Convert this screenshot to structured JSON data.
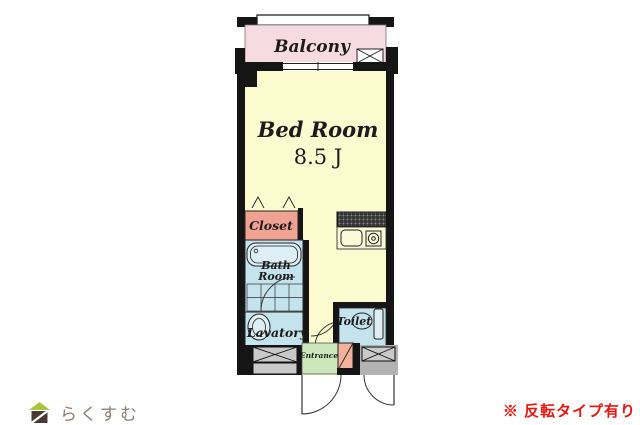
{
  "plan": {
    "balcony": "Balcony",
    "bedroom_name": "Bed Room",
    "bedroom_size": "8.5 J",
    "closet": "Closet",
    "bath_line1": "Bath",
    "bath_line2": "Room",
    "lavatory": "Lavatory",
    "toilet": "Toilet",
    "entrance": "Entrance"
  },
  "colors": {
    "balcony": "#f6dbe3",
    "room": "#fcfbd0",
    "counter": "#fbfad7",
    "closet": "#f0a392",
    "wet": "#c5e3ed",
    "fixture": "#ddeff5",
    "entrance": "#cde7bd",
    "cabinet": "#f2b29c",
    "porch": "#b3b3b3",
    "storage_box": "#c9c9c9",
    "wall": "#151515",
    "note_red": "#e8170e",
    "logo_text_color": "#8d7d70",
    "logo_roof_green": "#a6c73c",
    "logo_body_brown": "#4a3a33"
  },
  "footer": {
    "logo_text": "らくすむ",
    "note": "※ 反転タイプ有り"
  }
}
